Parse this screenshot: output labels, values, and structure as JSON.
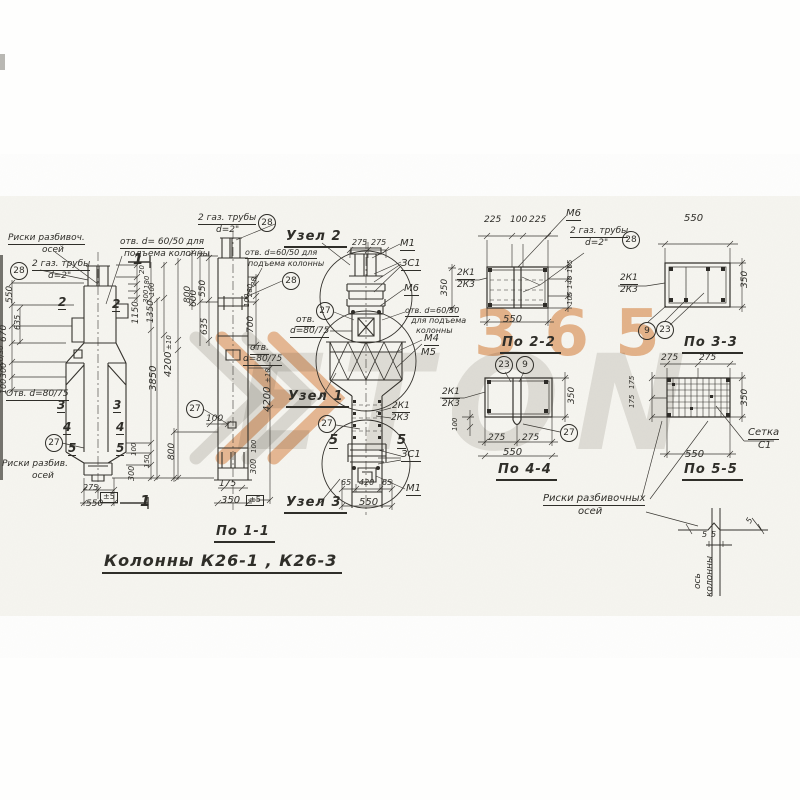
{
  "title": "Колонны К26-1 , К26-3",
  "colors": {
    "paper": "#f6f5f0",
    "ink": "#2f2e29",
    "watermark_orange": "#dd8038",
    "watermark_grey": "#bdbbb4"
  },
  "watermark": {
    "logo_text": "ETON",
    "number": "365"
  },
  "labels": [
    {
      "name": "note-riski-razbivoch",
      "text": "Риски разбивоч.",
      "x": 8,
      "y": 234,
      "fs": 9,
      "u": 1
    },
    {
      "name": "note-riski-razbivoch-2",
      "text": "осей",
      "x": 42,
      "y": 246,
      "fs": 9
    },
    {
      "name": "callout-28-left",
      "text": "28",
      "x": 10,
      "y": 262,
      "circ": 1
    },
    {
      "name": "note-gas-pipes-left",
      "text": "2 газ. трубы",
      "x": 32,
      "y": 260,
      "fs": 9,
      "u": 1
    },
    {
      "name": "note-gas-pipes-left-2",
      "text": "d=2\"",
      "x": 48,
      "y": 272,
      "fs": 9
    },
    {
      "name": "note-otv-6050-left",
      "text": "отв. d= 60/50 для",
      "x": 120,
      "y": 238,
      "fs": 9,
      "u": 1
    },
    {
      "name": "note-otv-6050-left-2",
      "text": "подъема колонны",
      "x": 124,
      "y": 250,
      "fs": 9
    },
    {
      "name": "section-mark-1-top",
      "text": "1",
      "x": 133,
      "y": 252,
      "fs": 15,
      "b": 1
    },
    {
      "name": "section-mark-1-bottom",
      "text": "1",
      "x": 140,
      "y": 494,
      "fs": 15,
      "b": 1
    },
    {
      "name": "section-mark-2a",
      "text": "2",
      "x": 58,
      "y": 296,
      "fs": 12,
      "b": 1,
      "u": 1
    },
    {
      "name": "section-mark-2b",
      "text": "2",
      "x": 112,
      "y": 298,
      "fs": 12,
      "b": 1,
      "u": 1
    },
    {
      "name": "section-mark-3a",
      "text": "3",
      "x": 57,
      "y": 399,
      "fs": 12,
      "b": 1,
      "u": 1
    },
    {
      "name": "section-mark-3b",
      "text": "3",
      "x": 113,
      "y": 399,
      "fs": 12,
      "b": 1,
      "u": 1
    },
    {
      "name": "section-mark-4a",
      "text": "4",
      "x": 63,
      "y": 421,
      "fs": 12,
      "b": 1,
      "u": 1
    },
    {
      "name": "section-mark-4b",
      "text": "4",
      "x": 116,
      "y": 421,
      "fs": 12,
      "b": 1,
      "u": 1
    },
    {
      "name": "section-mark-5a",
      "text": "5",
      "x": 68,
      "y": 442,
      "fs": 12,
      "b": 1,
      "u": 1
    },
    {
      "name": "section-mark-5b",
      "text": "5",
      "x": 116,
      "y": 442,
      "fs": 12,
      "b": 1,
      "u": 1
    },
    {
      "name": "callout-27-left",
      "text": "27",
      "x": 45,
      "y": 434,
      "circ": 1
    },
    {
      "name": "note-otv-8075-left",
      "text": "Отв. d=80/75",
      "x": 6,
      "y": 390,
      "fs": 9,
      "u": 1
    },
    {
      "name": "note-riski-razbiv-bottom",
      "text": "Риски разбив.",
      "x": 2,
      "y": 460,
      "fs": 9
    },
    {
      "name": "note-riski-razbiv-bottom-2",
      "text": "осей",
      "x": 32,
      "y": 472,
      "fs": 9
    },
    {
      "name": "dim-275-left-bottom",
      "text": "275",
      "x": 83,
      "y": 484,
      "fs": 8
    },
    {
      "name": "dim-tol5-left-bottom",
      "text": "±5",
      "x": 100,
      "y": 492,
      "fs": 8,
      "bx": 1
    },
    {
      "name": "dim-550-left-bottom",
      "text": "550",
      "x": 86,
      "y": 500,
      "fs": 9
    },
    {
      "name": "dim-550-left-v",
      "text": "550",
      "x": 6,
      "y": 286,
      "fs": 9,
      "rot": -90
    },
    {
      "name": "dim-670-left-v",
      "text": "670",
      "x": 0,
      "y": 325,
      "fs": 9,
      "rot": -90
    },
    {
      "name": "dim-635-left-v",
      "text": "635",
      "x": 14,
      "y": 315,
      "fs": 8,
      "rot": -90
    },
    {
      "name": "dim-400-30-left-v",
      "text": "400/30",
      "x": -2,
      "y": 344,
      "fs": 7,
      "rot": -90
    },
    {
      "name": "dim-300-left-v",
      "text": "300",
      "x": 0,
      "y": 363,
      "fs": 8,
      "rot": -90
    },
    {
      "name": "dim-100-left-v",
      "text": "100",
      "x": 0,
      "y": 379,
      "fs": 8,
      "rot": -90
    },
    {
      "name": "dim-20-v1",
      "text": "20",
      "x": 139,
      "y": 265,
      "fs": 7,
      "rot": -90
    },
    {
      "name": "dim-180-v1",
      "text": "180",
      "x": 144,
      "y": 276,
      "fs": 7,
      "rot": -90
    },
    {
      "name": "dim-100-v1",
      "text": "100",
      "x": 149,
      "y": 283,
      "fs": 7,
      "rot": -90
    },
    {
      "name": "dim-300-v1",
      "text": "300",
      "x": 143,
      "y": 290,
      "fs": 7,
      "rot": -90
    },
    {
      "name": "dim-1150",
      "text": "1150",
      "x": 132,
      "y": 302,
      "fs": 9,
      "rot": -90
    },
    {
      "name": "dim-1350",
      "text": "1350",
      "x": 147,
      "y": 301,
      "fs": 9,
      "rot": -90
    },
    {
      "name": "dim-tol10-v1",
      "text": "±10",
      "x": 166,
      "y": 337,
      "fs": 7,
      "rot": -90
    },
    {
      "name": "dim-4200-v1",
      "text": "4200",
      "x": 164,
      "y": 352,
      "fs": 10,
      "rot": -90
    },
    {
      "name": "dim-3850",
      "text": "3850",
      "x": 149,
      "y": 366,
      "fs": 10,
      "rot": -90
    },
    {
      "name": "dim-800-v1",
      "text": "800",
      "x": 184,
      "y": 286,
      "fs": 9,
      "rot": -90
    },
    {
      "name": "dim-100-v1b",
      "text": "100",
      "x": 131,
      "y": 443,
      "fs": 7,
      "rot": -90
    },
    {
      "name": "dim-150-v1",
      "text": "150",
      "x": 144,
      "y": 455,
      "fs": 7,
      "rot": -90
    },
    {
      "name": "dim-300-v1b",
      "text": "300",
      "x": 128,
      "y": 466,
      "fs": 8,
      "rot": -90
    },
    {
      "name": "note-gas-pipes-mid",
      "text": "2 газ. трубы",
      "x": 198,
      "y": 214,
      "fs": 9,
      "u": 1
    },
    {
      "name": "note-gas-pipes-mid-2",
      "text": "d=2\"",
      "x": 216,
      "y": 226,
      "fs": 9
    },
    {
      "name": "callout-28-mid-top",
      "text": "28",
      "x": 258,
      "y": 214,
      "circ": 1
    },
    {
      "name": "note-otv-6050-mid",
      "text": "отв. d=60/50 для",
      "x": 245,
      "y": 249,
      "fs": 8,
      "u": 1
    },
    {
      "name": "note-otv-6050-mid-2",
      "text": "подъема колонны",
      "x": 248,
      "y": 260,
      "fs": 8
    },
    {
      "name": "callout-28-mid",
      "text": "28",
      "x": 282,
      "y": 272,
      "circ": 1
    },
    {
      "name": "dim-550-mid-v",
      "text": "550",
      "x": 199,
      "y": 280,
      "fs": 9,
      "rot": -90
    },
    {
      "name": "dim-600-mid-v",
      "text": "600",
      "x": 190,
      "y": 290,
      "fs": 9,
      "rot": -90
    },
    {
      "name": "dim-635-mid-v",
      "text": "635",
      "x": 201,
      "y": 318,
      "fs": 9,
      "rot": -90
    },
    {
      "name": "dim-20-mid",
      "text": "20",
      "x": 251,
      "y": 277,
      "fs": 7,
      "rot": -90
    },
    {
      "name": "dim-280-mid",
      "text": "280",
      "x": 247,
      "y": 284,
      "fs": 7,
      "rot": -90
    },
    {
      "name": "dim-100-mid",
      "text": "100",
      "x": 244,
      "y": 294,
      "fs": 7,
      "rot": -90
    },
    {
      "name": "dim-700-mid",
      "text": "700",
      "x": 247,
      "y": 316,
      "fs": 9,
      "rot": -90
    },
    {
      "name": "note-otv-8075-mid",
      "text": "отв.",
      "x": 250,
      "y": 344,
      "fs": 9,
      "u": 1
    },
    {
      "name": "note-otv-8075-mid-2",
      "text": "d=80/75",
      "x": 243,
      "y": 355,
      "fs": 9,
      "u": 1
    },
    {
      "name": "callout-27-mid",
      "text": "27",
      "x": 186,
      "y": 400,
      "circ": 1
    },
    {
      "name": "dim-100-mid-b",
      "text": "100",
      "x": 206,
      "y": 415,
      "fs": 9
    },
    {
      "name": "dim-800-mid",
      "text": "800",
      "x": 168,
      "y": 443,
      "fs": 9,
      "rot": -90
    },
    {
      "name": "dim-100-mid-r",
      "text": "100",
      "x": 251,
      "y": 440,
      "fs": 7,
      "rot": -90
    },
    {
      "name": "dim-300-mid-r",
      "text": "300",
      "x": 250,
      "y": 459,
      "fs": 8,
      "rot": -90
    },
    {
      "name": "dim-175-mid",
      "text": "175",
      "x": 219,
      "y": 480,
      "fs": 9
    },
    {
      "name": "dim-350-mid",
      "text": "350",
      "x": 221,
      "y": 496,
      "fs": 10
    },
    {
      "name": "dim-tol5-mid",
      "text": "±5",
      "x": 246,
      "y": 495,
      "fs": 8,
      "bx": 1
    },
    {
      "name": "dim-tol10-mid",
      "text": "±10",
      "x": 265,
      "y": 370,
      "fs": 7,
      "rot": -90
    },
    {
      "name": "dim-4200-mid",
      "text": "4200",
      "x": 263,
      "y": 387,
      "fs": 10,
      "rot": -90
    },
    {
      "name": "caption-uzel-2",
      "text": "Узел 2",
      "x": 284,
      "y": 230,
      "fs": 13,
      "cap": 1
    },
    {
      "name": "dim-275a-uzel2",
      "text": "275",
      "x": 352,
      "y": 239,
      "fs": 8
    },
    {
      "name": "dim-275b-uzel2",
      "text": "275",
      "x": 371,
      "y": 239,
      "fs": 8
    },
    {
      "name": "label-m1-top",
      "text": "М1",
      "x": 400,
      "y": 239,
      "fs": 10,
      "u": 1
    },
    {
      "name": "label-3c1-top",
      "text": "ЗС1",
      "x": 401,
      "y": 259,
      "fs": 10,
      "u": 1
    },
    {
      "name": "label-m6-center",
      "text": "М6",
      "x": 404,
      "y": 284,
      "fs": 10,
      "u": 1
    },
    {
      "name": "callout-27-center-top",
      "text": "27",
      "x": 316,
      "y": 302,
      "circ": 1
    },
    {
      "name": "note-otv-8075-center",
      "text": "отв.",
      "x": 296,
      "y": 316,
      "fs": 9,
      "u": 1
    },
    {
      "name": "note-otv-8075-center-2",
      "text": "d=80/75",
      "x": 290,
      "y": 327,
      "fs": 9,
      "u": 1
    },
    {
      "name": "note-otv-6050-center",
      "text": "отв. d=60/50",
      "x": 405,
      "y": 307,
      "fs": 8,
      "u": 1
    },
    {
      "name": "note-otv-6050-center-2",
      "text": "для подъема",
      "x": 411,
      "y": 317,
      "fs": 8
    },
    {
      "name": "note-otv-6050-center-3",
      "text": "колонны",
      "x": 416,
      "y": 327,
      "fs": 8
    },
    {
      "name": "label-m4",
      "text": "М4",
      "x": 424,
      "y": 334,
      "fs": 10,
      "u": 1
    },
    {
      "name": "label-m5",
      "text": "М5",
      "x": 421,
      "y": 348,
      "fs": 10
    },
    {
      "name": "caption-uzel-1",
      "text": "Узел 1",
      "x": 286,
      "y": 390,
      "fs": 13,
      "cap": 1
    },
    {
      "name": "label-2k1-center",
      "text": "2К1",
      "x": 392,
      "y": 402,
      "fs": 9,
      "u": 1
    },
    {
      "name": "label-2k3-center",
      "text": "2К3",
      "x": 391,
      "y": 414,
      "fs": 9
    },
    {
      "name": "callout-27-center-bot",
      "text": "27",
      "x": 318,
      "y": 415,
      "circ": 1
    },
    {
      "name": "section-mark-5c",
      "text": "5",
      "x": 329,
      "y": 434,
      "fs": 13,
      "b": 1,
      "u": 1
    },
    {
      "name": "section-mark-5d",
      "text": "5",
      "x": 397,
      "y": 434,
      "fs": 13,
      "b": 1,
      "u": 1
    },
    {
      "name": "label-3c1-bottom",
      "text": "ЗС1",
      "x": 401,
      "y": 450,
      "fs": 10,
      "u": 1
    },
    {
      "name": "dim-65a-uzel3",
      "text": "65",
      "x": 341,
      "y": 479,
      "fs": 8
    },
    {
      "name": "dim-420-uzel3",
      "text": "420",
      "x": 359,
      "y": 479,
      "fs": 8
    },
    {
      "name": "dim-65b-uzel3",
      "text": "65",
      "x": 382,
      "y": 479,
      "fs": 8
    },
    {
      "name": "label-m1-bottom",
      "text": "М1",
      "x": 406,
      "y": 484,
      "fs": 10,
      "u": 1
    },
    {
      "name": "dim-550-uzel3",
      "text": "550",
      "x": 359,
      "y": 498,
      "fs": 10
    },
    {
      "name": "caption-uzel-3",
      "text": "Узел 3",
      "x": 284,
      "y": 496,
      "fs": 13,
      "cap": 1
    },
    {
      "name": "dim-350-po22-left",
      "text": "350",
      "x": 441,
      "y": 279,
      "fs": 9,
      "rot": -90
    },
    {
      "name": "dim-225a-po22",
      "text": "225",
      "x": 484,
      "y": 216,
      "fs": 9
    },
    {
      "name": "dim-100-po22",
      "text": "100",
      "x": 510,
      "y": 216,
      "fs": 9
    },
    {
      "name": "dim-225b-po22",
      "text": "225",
      "x": 529,
      "y": 216,
      "fs": 9
    },
    {
      "name": "label-m6-po22",
      "text": "М6",
      "x": 566,
      "y": 209,
      "fs": 10,
      "u": 1
    },
    {
      "name": "note-gas-pipes-po22",
      "text": "2 газ. трубы",
      "x": 570,
      "y": 227,
      "fs": 9,
      "u": 1
    },
    {
      "name": "note-gas-pipes-po22-2",
      "text": "d=2\"",
      "x": 585,
      "y": 239,
      "fs": 9
    },
    {
      "name": "callout-28-po22",
      "text": "28",
      "x": 622,
      "y": 231,
      "circ": 1
    },
    {
      "name": "label-2k1-po22",
      "text": "2К1",
      "x": 457,
      "y": 269,
      "fs": 9,
      "u": 1
    },
    {
      "name": "label-2k3-po22",
      "text": "2К3",
      "x": 457,
      "y": 281,
      "fs": 9
    },
    {
      "name": "dim-105a-po22",
      "text": "105",
      "x": 567,
      "y": 260,
      "fs": 7,
      "rot": -90
    },
    {
      "name": "dim-140-po22",
      "text": "140",
      "x": 567,
      "y": 276,
      "fs": 7,
      "rot": -90
    },
    {
      "name": "dim-105b-po22",
      "text": "105",
      "x": 567,
      "y": 292,
      "fs": 7,
      "rot": -90
    },
    {
      "name": "dim-550-po22",
      "text": "550",
      "x": 503,
      "y": 315,
      "fs": 10
    },
    {
      "name": "caption-po-2-2",
      "text": "По 2-2",
      "x": 500,
      "y": 336,
      "fs": 13,
      "cap": 1
    },
    {
      "name": "dim-550-po33",
      "text": "550",
      "x": 684,
      "y": 214,
      "fs": 10
    },
    {
      "name": "label-2k1-po33",
      "text": "2К1",
      "x": 620,
      "y": 274,
      "fs": 9,
      "u": 1
    },
    {
      "name": "label-2k3-po33",
      "text": "2К3",
      "x": 620,
      "y": 286,
      "fs": 9
    },
    {
      "name": "dim-350-po33",
      "text": "350",
      "x": 741,
      "y": 271,
      "fs": 9,
      "rot": -90
    },
    {
      "name": "callout-9-po33",
      "text": "9",
      "x": 638,
      "y": 322,
      "circ": 1
    },
    {
      "name": "callout-23-po33",
      "text": "23",
      "x": 656,
      "y": 321,
      "circ": 1
    },
    {
      "name": "caption-po-3-3",
      "text": "По 3-3",
      "x": 682,
      "y": 336,
      "fs": 13,
      "cap": 1
    },
    {
      "name": "callout-23-po44",
      "text": "23",
      "x": 495,
      "y": 356,
      "circ": 1
    },
    {
      "name": "callout-9-po44",
      "text": "9",
      "x": 516,
      "y": 356,
      "circ": 1
    },
    {
      "name": "label-2k1-po44",
      "text": "2К1",
      "x": 442,
      "y": 388,
      "fs": 9,
      "u": 1
    },
    {
      "name": "label-2k3-po44",
      "text": "2К3",
      "x": 442,
      "y": 400,
      "fs": 9
    },
    {
      "name": "dim-100-po44",
      "text": "100",
      "x": 452,
      "y": 418,
      "fs": 7,
      "rot": -90
    },
    {
      "name": "dim-350-po44",
      "text": "350",
      "x": 568,
      "y": 387,
      "fs": 9,
      "rot": -90
    },
    {
      "name": "dim-275a-po44",
      "text": "275",
      "x": 488,
      "y": 434,
      "fs": 9
    },
    {
      "name": "dim-275b-po44",
      "text": "275",
      "x": 522,
      "y": 434,
      "fs": 9
    },
    {
      "name": "dim-550-po44",
      "text": "550",
      "x": 503,
      "y": 448,
      "fs": 10
    },
    {
      "name": "callout-27-po44",
      "text": "27",
      "x": 560,
      "y": 424,
      "circ": 1
    },
    {
      "name": "caption-po-4-4",
      "text": "По 4-4",
      "x": 496,
      "y": 463,
      "fs": 13,
      "cap": 1
    },
    {
      "name": "dim-275a-po55",
      "text": "275",
      "x": 661,
      "y": 354,
      "fs": 9
    },
    {
      "name": "dim-275b-po55",
      "text": "275",
      "x": 699,
      "y": 354,
      "fs": 9
    },
    {
      "name": "dim-175a-po55",
      "text": "175",
      "x": 629,
      "y": 376,
      "fs": 7,
      "rot": -90
    },
    {
      "name": "dim-175b-po55",
      "text": "175",
      "x": 629,
      "y": 395,
      "fs": 7,
      "rot": -90
    },
    {
      "name": "dim-350-po55",
      "text": "350",
      "x": 741,
      "y": 389,
      "fs": 9,
      "rot": -90
    },
    {
      "name": "dim-550-po55",
      "text": "550",
      "x": 685,
      "y": 450,
      "fs": 10
    },
    {
      "name": "label-setka",
      "text": "Сетка",
      "x": 748,
      "y": 428,
      "fs": 10,
      "u": 1
    },
    {
      "name": "label-setka-2",
      "text": "С1",
      "x": 758,
      "y": 441,
      "fs": 10
    },
    {
      "name": "caption-po-5-5",
      "text": "По 5-5",
      "x": 682,
      "y": 463,
      "fs": 13,
      "cap": 1
    },
    {
      "name": "caption-po-1-1",
      "text": "По 1-1",
      "x": 214,
      "y": 525,
      "fs": 13,
      "cap": 1
    },
    {
      "name": "drawing-title",
      "text": "Колонны К26-1 , К26-3",
      "x": 102,
      "y": 553,
      "fs": 16,
      "cap": 1
    },
    {
      "name": "note-riski-razbivochnyh",
      "text": "Риски разбивочных",
      "x": 543,
      "y": 494,
      "fs": 10,
      "u": 1
    },
    {
      "name": "note-riski-razbivochnyh-2",
      "text": "осей",
      "x": 578,
      "y": 507,
      "fs": 10
    },
    {
      "name": "dim-5a-axis",
      "text": "5",
      "x": 702,
      "y": 531,
      "fs": 8
    },
    {
      "name": "dim-5b-axis",
      "text": "5",
      "x": 711,
      "y": 531,
      "fs": 8
    },
    {
      "name": "dim-5c-axis",
      "text": "5",
      "x": 745,
      "y": 516,
      "fs": 8,
      "rot": -60
    },
    {
      "name": "label-os-kolonny",
      "text": "ось",
      "x": 694,
      "y": 572,
      "fs": 9,
      "rot": -90
    },
    {
      "name": "label-os-kolonny-2",
      "text": "колонны",
      "x": 706,
      "y": 558,
      "fs": 9,
      "rot": -90
    }
  ]
}
